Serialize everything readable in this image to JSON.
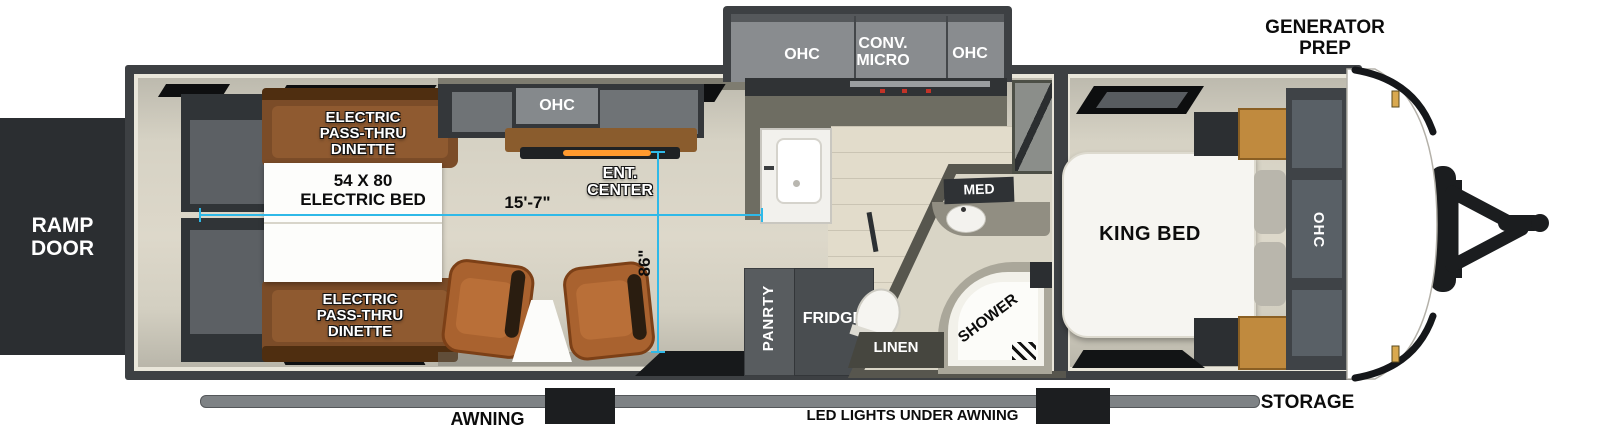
{
  "colors": {
    "dimension_line": "#2fb9e8",
    "wall": "#3d4043",
    "floor": "#d6d2c4",
    "dinette_wood": "#7b4c28",
    "nightstand_wood": "#c08a3e"
  },
  "exterior": {
    "generator_prep": "GENERATOR\nPREP",
    "ramp_door": "RAMP\nDOOR",
    "storage": "STORAGE",
    "awning": "AWNING",
    "led_lights": "LED LIGHTS UNDER AWNING"
  },
  "dimensions": {
    "length": "15'-7\"",
    "interior_height": "86\""
  },
  "garage": {
    "dinette_top": "ELECTRIC\nPASS-THRU\nDINETTE",
    "electric_bed": "54 X 80\nELECTRIC BED",
    "dinette_bottom": "ELECTRIC\nPASS-THRU\nDINETTE"
  },
  "living": {
    "ohc": "OHC",
    "ent_center": "ENT.\nCENTER"
  },
  "kitchen": {
    "ohc_left": "OHC",
    "conv_micro": "CONV.\nMICRO",
    "ohc_right": "OHC",
    "pantry": "PANRTY",
    "fridge": "FRIDGE"
  },
  "bathroom": {
    "med": "MED",
    "shower": "SHOWER",
    "linen": "LINEN"
  },
  "bedroom": {
    "king_bed": "KING BED",
    "ohc": "OHC"
  }
}
